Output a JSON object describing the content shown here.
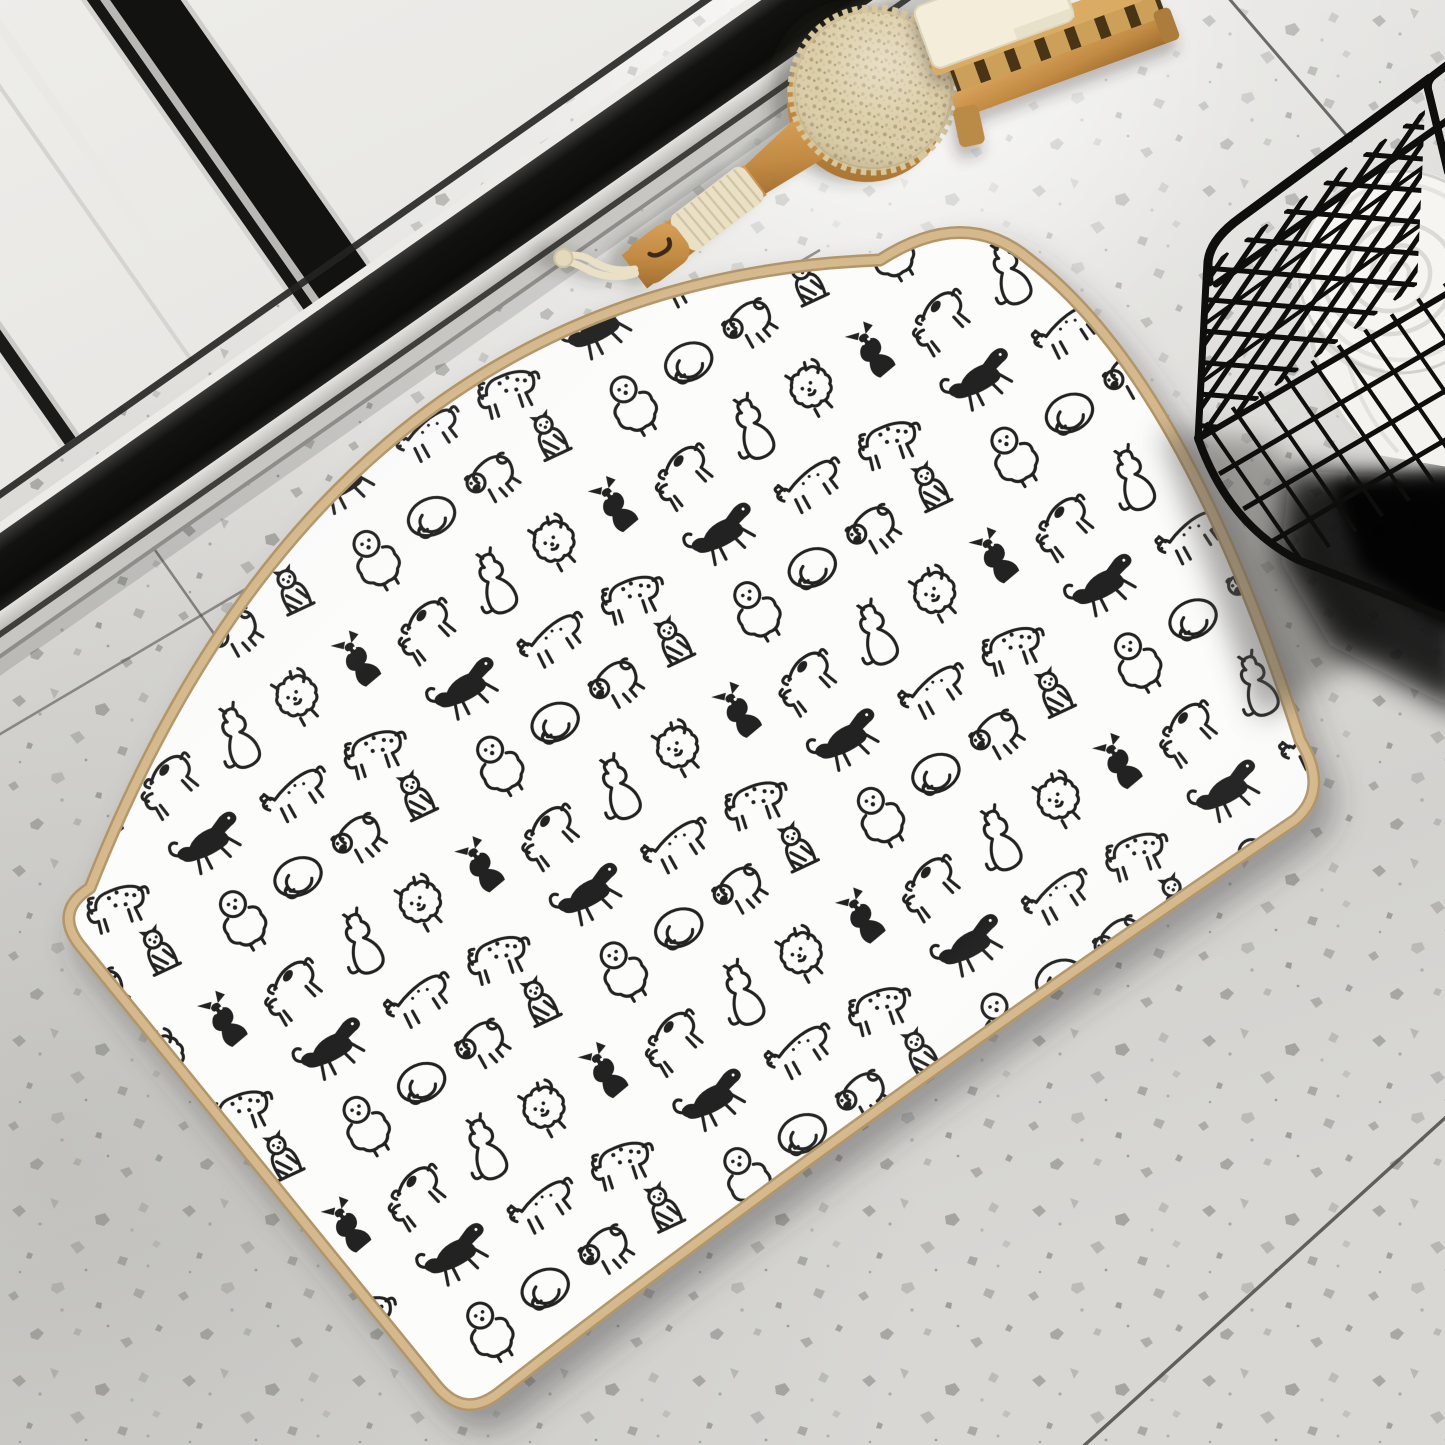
{
  "scene": {
    "title": "White bath mat with black doodle dog pattern on terrazzo bathroom floor",
    "objects": [
      {
        "id": "terrazzo-floor",
        "label": "speckled terrazzo tile floor with diagonal grout lines"
      },
      {
        "id": "shower-door",
        "label": "black aluminium framed glass shower door, top left"
      },
      {
        "id": "dog-mat",
        "label": "white rectangular mat with hand drawn black doodle dogs and beige binding"
      },
      {
        "id": "body-brush",
        "label": "round wooden bath brush with rope wrapped handle and rope loop"
      },
      {
        "id": "soap-dish",
        "label": "wooden slatted soap rack with cream soap bar, top right"
      },
      {
        "id": "wire-basket",
        "label": "black metal wire storage basket, right side"
      },
      {
        "id": "towel-roll",
        "label": "rolled white towel inside the wire basket"
      },
      {
        "id": "basket-shadow",
        "label": "dark cast shadow under the wire basket"
      }
    ],
    "mat_pattern_dogs": [
      "spotted terrier",
      "sitting puppy",
      "pomeranian",
      "running border collie",
      "dachshund",
      "dalmatian",
      "bichon frise",
      "black chihuahua",
      "curled sleeping dog",
      "pug",
      "sitting yorkie"
    ]
  },
  "colors": {
    "floor_base": "#dbdad7",
    "floor_bright": "#f3f2f0",
    "floor_speckle": "#82827f",
    "grout": "#4b4b48",
    "door_frame": "#151513",
    "door_glass": "#f2f1ee",
    "frame_silver": "#d9d8d4",
    "mat_white": "#fcfcfb",
    "mat_trim": "#d5b98c",
    "mat_trim_dark": "#b2966a",
    "doodle_ink": "#212121",
    "brush_wood": "#c28a43",
    "brush_bristle": "#dbcda7",
    "rope": "#eae0c6",
    "soap_wood": "#c6934e",
    "soap_bar": "#f3edda",
    "basket_wire": "#0e0e0d",
    "towel": "#f4f3ef",
    "shadow_dark": "#0b0b0a"
  }
}
